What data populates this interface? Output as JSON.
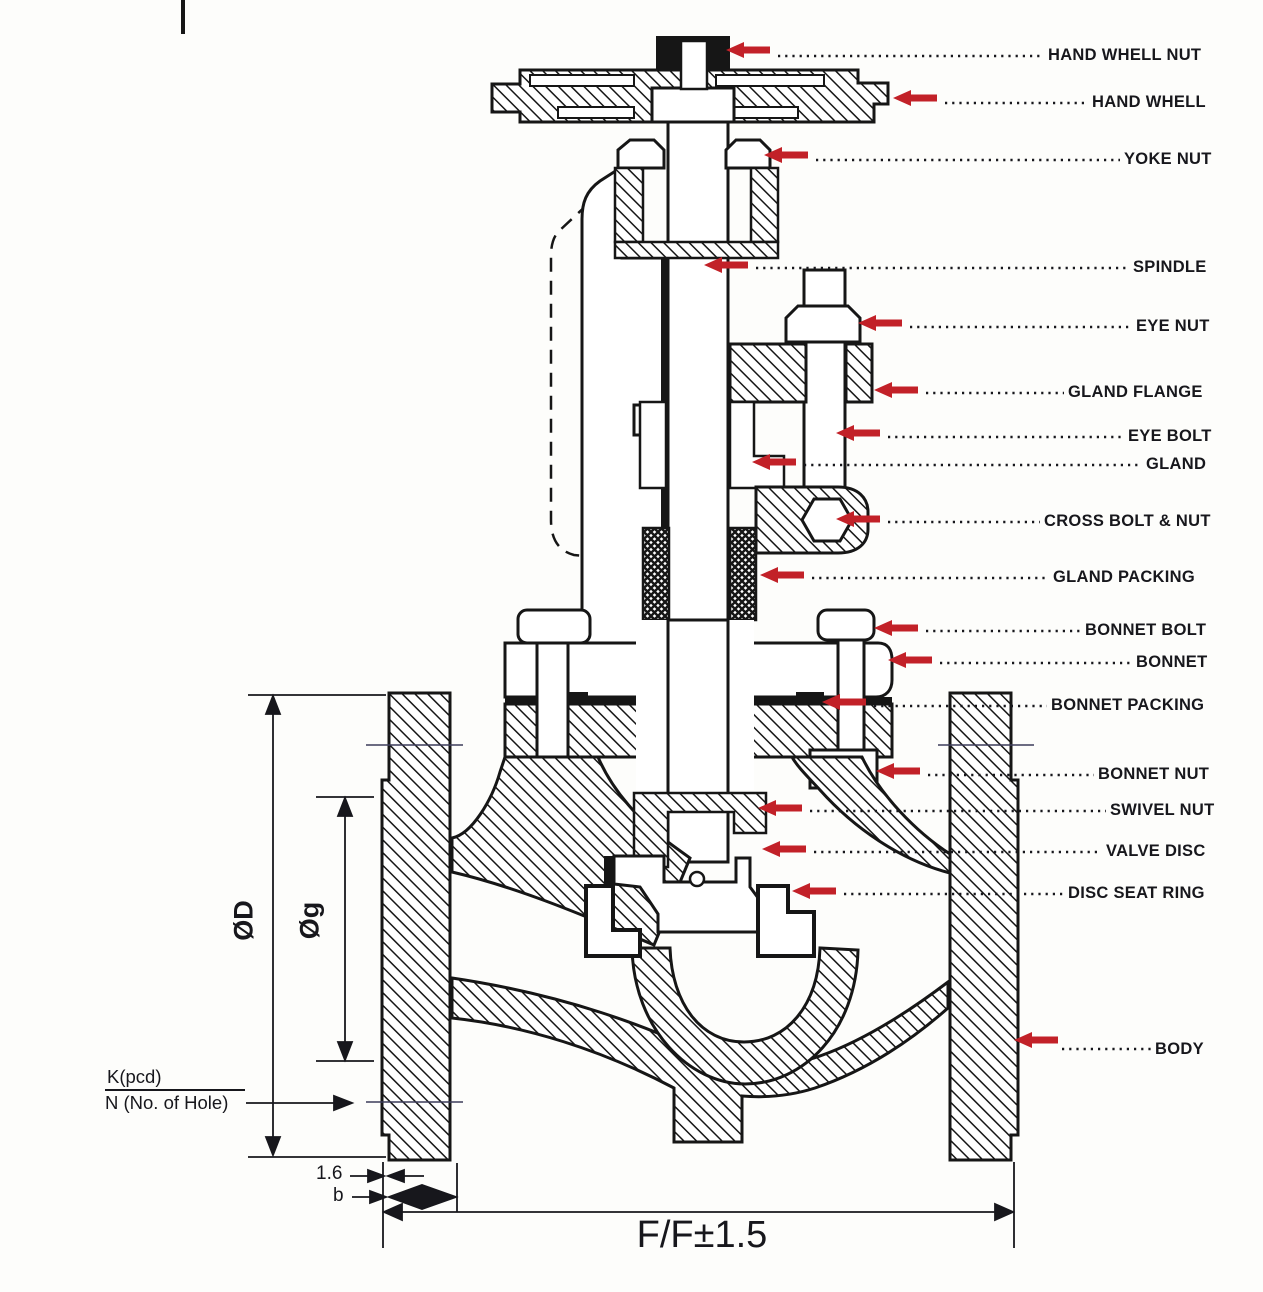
{
  "parts": [
    {
      "name": "hand-whell-nut",
      "label": "HAND WHELL NUT"
    },
    {
      "name": "hand-whell",
      "label": "HAND WHELL"
    },
    {
      "name": "yoke-nut",
      "label": "YOKE NUT"
    },
    {
      "name": "spindle",
      "label": "SPINDLE"
    },
    {
      "name": "eye-nut",
      "label": "EYE NUT"
    },
    {
      "name": "gland-flange",
      "label": "GLAND FLANGE"
    },
    {
      "name": "eye-bolt",
      "label": "EYE BOLT"
    },
    {
      "name": "gland",
      "label": "GLAND"
    },
    {
      "name": "cross-bolt-nut",
      "label": "CROSS BOLT & NUT"
    },
    {
      "name": "gland-packing",
      "label": "GLAND PACKING"
    },
    {
      "name": "bonnet-bolt",
      "label": "BONNET BOLT"
    },
    {
      "name": "bonnet",
      "label": "BONNET"
    },
    {
      "name": "bonnet-packing",
      "label": "BONNET PACKING"
    },
    {
      "name": "bonnet-nut",
      "label": "BONNET NUT"
    },
    {
      "name": "swivel-nut",
      "label": "SWIVEL NUT"
    },
    {
      "name": "valve-disc",
      "label": "VALVE DISC"
    },
    {
      "name": "disc-seat-ring",
      "label": "DISC SEAT RING"
    },
    {
      "name": "body",
      "label": "BODY"
    }
  ],
  "dimensions": {
    "outer_diameter": "ØD",
    "gasket_diameter": "Øg",
    "pcd": "K(pcd)",
    "holes": "N (No. of Hole)",
    "raised_face": "1.6",
    "flange_thickness": "b",
    "face_to_face": "F/F±1.5"
  },
  "colors": {
    "arrow_red": "#c22128",
    "line_black": "#111111"
  }
}
